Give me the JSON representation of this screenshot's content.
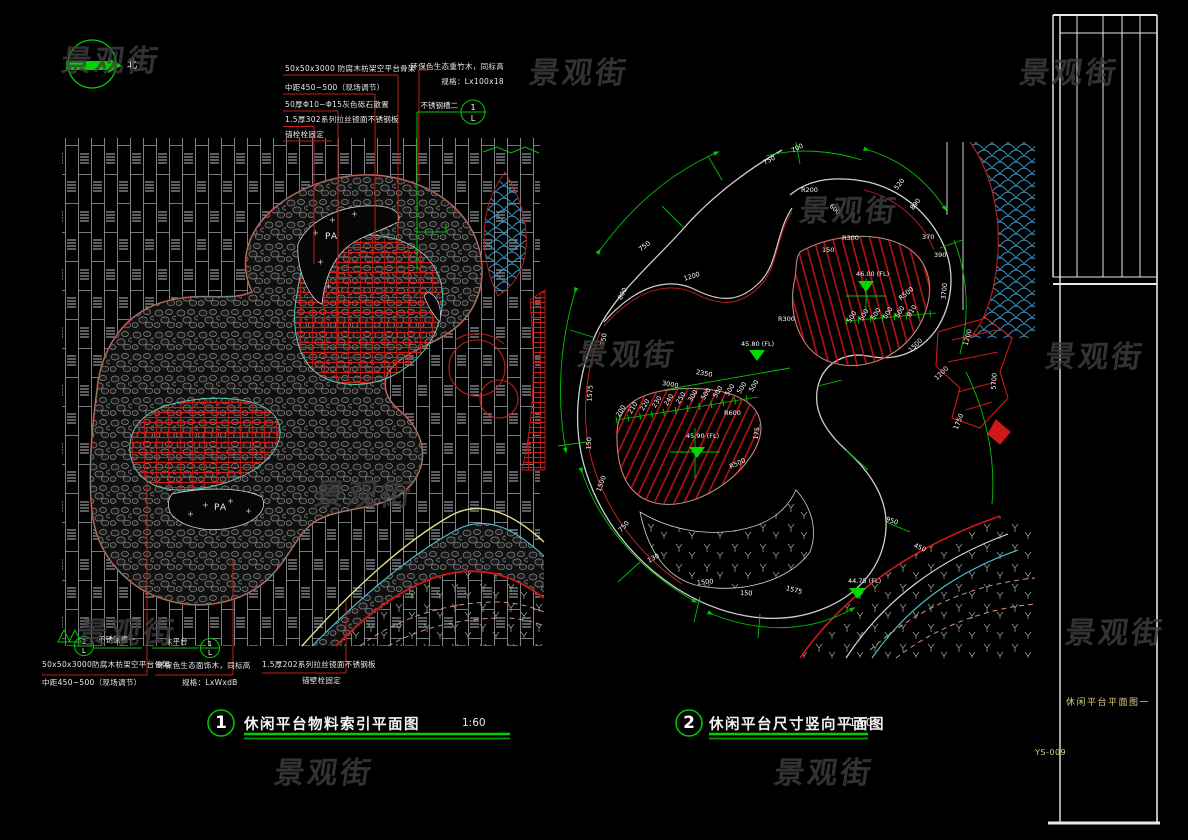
{
  "watermark": {
    "text": "景观街",
    "color": "#3f3f3f",
    "positions": [
      [
        62,
        36
      ],
      [
        530,
        48
      ],
      [
        1020,
        48
      ],
      [
        800,
        186
      ],
      [
        578,
        330
      ],
      [
        1046,
        332
      ],
      [
        315,
        470
      ],
      [
        78,
        608
      ],
      [
        1066,
        608
      ],
      [
        275,
        748
      ],
      [
        775,
        748
      ]
    ]
  },
  "north": {
    "label": "北"
  },
  "sheet": {
    "name": "休闲平台平面图一",
    "no": "YS-009"
  },
  "figure1": {
    "num": "1",
    "title": "休闲平台物料索引平面图",
    "scale": "1:60",
    "pa_label": "PA",
    "notes_top_left": [
      "50x50x3000 防腐木枋架空平台骨架",
      "中距450~500（现场调节）",
      "50厚Φ10~Φ15灰色砾石散置",
      "1.5厚302系列拉丝镜面不锈钢板",
      "锚栓栓固定"
    ],
    "notes_top_right": [
      "环保色生态重竹木，同标高",
      "规格：Lx100x18"
    ],
    "callout_top_right": "不锈钢槽二",
    "callout_bubble_top": "1",
    "callout_bubble_bottom": "L",
    "bottom_left": {
      "label": "不锈钢槽一",
      "bubble_top": "1",
      "bubble_bottom": "L",
      "lines": [
        "50x50x3000防腐木枋架空平台骨架",
        "中距450~500（现场调节）"
      ]
    },
    "bottom_mid": {
      "label": "木平台",
      "bubble_top": "1",
      "bubble_bottom": "L",
      "lines": [
        "环保色生态面饰木，同标高",
        "规格：LxWxdB"
      ]
    },
    "bottom_right": {
      "lines": [
        "1.5厚202系列拉丝镜面不锈钢板",
        "锚壁栓固定"
      ]
    }
  },
  "figure2": {
    "num": "2",
    "title": "休闲平台尺寸竖向平面图",
    "scale": "1:60",
    "elevations": [
      "45.80 (FL)",
      "45.90 (FL)",
      "46.00 (FL)",
      "44.75 (FL)"
    ],
    "labels": [
      {
        "t": "45.80 (FL)",
        "x": 741,
        "y": 341,
        "r": 0
      },
      {
        "t": "45.90 (FL)",
        "x": 686,
        "y": 433,
        "r": 0
      },
      {
        "t": "46.00 (FL)",
        "x": 856,
        "y": 271,
        "r": 0
      },
      {
        "t": "44.75 (FL)",
        "x": 848,
        "y": 578,
        "r": 0
      },
      {
        "t": "750",
        "x": 640,
        "y": 247,
        "r": -38
      },
      {
        "t": "1200",
        "x": 684,
        "y": 276,
        "r": -18
      },
      {
        "t": "800",
        "x": 620,
        "y": 296,
        "r": -62
      },
      {
        "t": "750",
        "x": 603,
        "y": 342,
        "r": -80
      },
      {
        "t": "1575",
        "x": 590,
        "y": 398,
        "r": -86
      },
      {
        "t": "150",
        "x": 589,
        "y": 446,
        "r": -86
      },
      {
        "t": "1500",
        "x": 599,
        "y": 488,
        "r": -70
      },
      {
        "t": "750",
        "x": 620,
        "y": 528,
        "r": -48
      },
      {
        "t": "130",
        "x": 648,
        "y": 558,
        "r": -28
      },
      {
        "t": "1500",
        "x": 697,
        "y": 580,
        "r": -6
      },
      {
        "t": "150",
        "x": 740,
        "y": 590,
        "r": 2
      },
      {
        "t": "1575",
        "x": 786,
        "y": 585,
        "r": 14
      },
      {
        "t": "3000",
        "x": 662,
        "y": 380,
        "r": 10
      },
      {
        "t": "2350",
        "x": 696,
        "y": 369,
        "r": 10
      },
      {
        "t": "200",
        "x": 618,
        "y": 413,
        "r": -58
      },
      {
        "t": "210",
        "x": 630,
        "y": 410,
        "r": -58
      },
      {
        "t": "220",
        "x": 642,
        "y": 407,
        "r": -58
      },
      {
        "t": "230",
        "x": 654,
        "y": 404,
        "r": -58
      },
      {
        "t": "240",
        "x": 666,
        "y": 402,
        "r": -58
      },
      {
        "t": "250",
        "x": 678,
        "y": 400,
        "r": -58
      },
      {
        "t": "300",
        "x": 690,
        "y": 398,
        "r": -58
      },
      {
        "t": "500",
        "x": 703,
        "y": 396,
        "r": -58
      },
      {
        "t": "500",
        "x": 715,
        "y": 394,
        "r": -58
      },
      {
        "t": "500",
        "x": 727,
        "y": 392,
        "r": -58
      },
      {
        "t": "500",
        "x": 739,
        "y": 390,
        "r": -58
      },
      {
        "t": "500",
        "x": 751,
        "y": 388,
        "r": -58
      },
      {
        "t": "500",
        "x": 849,
        "y": 319,
        "r": -58
      },
      {
        "t": "500",
        "x": 861,
        "y": 317,
        "r": -58
      },
      {
        "t": "500",
        "x": 873,
        "y": 316,
        "r": -58
      },
      {
        "t": "500",
        "x": 885,
        "y": 315,
        "r": -58
      },
      {
        "t": "500",
        "x": 897,
        "y": 314,
        "r": -58
      },
      {
        "t": "910",
        "x": 909,
        "y": 313,
        "r": -58
      },
      {
        "t": "R600",
        "x": 724,
        "y": 410,
        "r": 0
      },
      {
        "t": "R500",
        "x": 730,
        "y": 464,
        "r": -25
      },
      {
        "t": "R200",
        "x": 801,
        "y": 187,
        "r": 0
      },
      {
        "t": "R300",
        "x": 842,
        "y": 235,
        "r": 0
      },
      {
        "t": "150",
        "x": 822,
        "y": 247,
        "r": 0
      },
      {
        "t": "600",
        "x": 830,
        "y": 202,
        "r": 42
      },
      {
        "t": "750",
        "x": 764,
        "y": 160,
        "r": -28
      },
      {
        "t": "700",
        "x": 792,
        "y": 148,
        "r": -28
      },
      {
        "t": "520",
        "x": 896,
        "y": 186,
        "r": -52
      },
      {
        "t": "890",
        "x": 912,
        "y": 206,
        "r": -52
      },
      {
        "t": "370",
        "x": 922,
        "y": 234,
        "r": 0
      },
      {
        "t": "390",
        "x": 934,
        "y": 252,
        "r": 0
      },
      {
        "t": "R500",
        "x": 900,
        "y": 296,
        "r": -40
      },
      {
        "t": "3700",
        "x": 944,
        "y": 296,
        "r": -85
      },
      {
        "t": "1500",
        "x": 910,
        "y": 348,
        "r": -45
      },
      {
        "t": "1200",
        "x": 936,
        "y": 376,
        "r": -45
      },
      {
        "t": "1750",
        "x": 956,
        "y": 426,
        "r": -68
      },
      {
        "t": "5700",
        "x": 994,
        "y": 386,
        "r": -86
      },
      {
        "t": "1200",
        "x": 966,
        "y": 342,
        "r": -75
      },
      {
        "t": "950",
        "x": 886,
        "y": 516,
        "r": 18
      },
      {
        "t": "450",
        "x": 914,
        "y": 542,
        "r": 24
      },
      {
        "t": "175",
        "x": 756,
        "y": 436,
        "r": -80
      },
      {
        "t": "R300",
        "x": 778,
        "y": 316,
        "r": 0
      }
    ]
  }
}
